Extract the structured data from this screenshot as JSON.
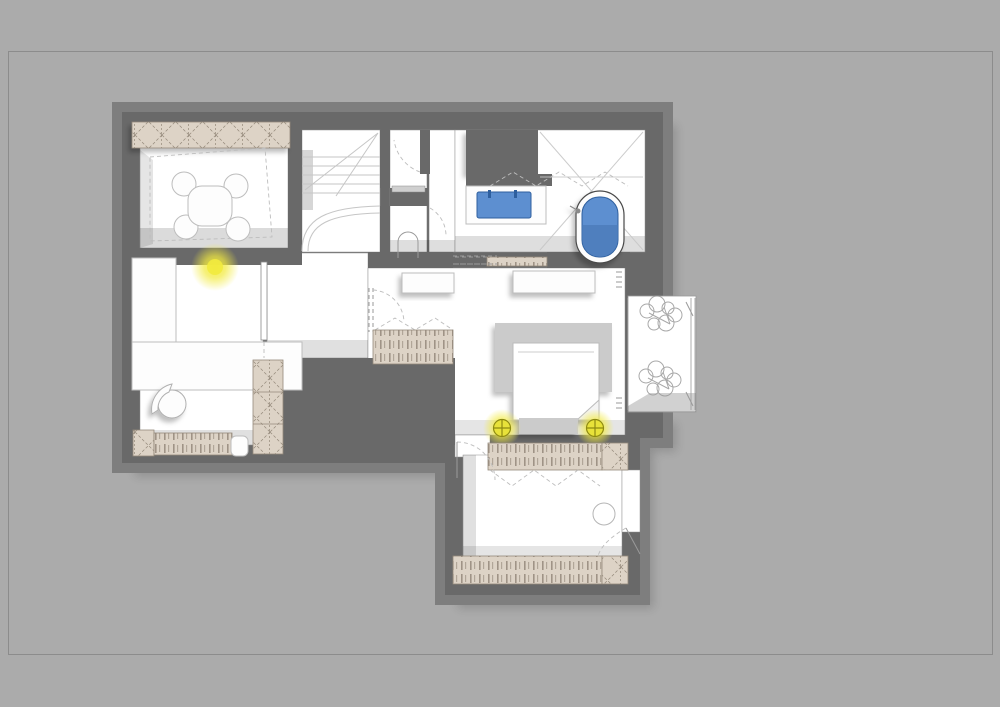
{
  "document": {
    "type": "architectural-floor-plan",
    "style": "furnished attic floor plan with extruded 3D walls on grey sheet",
    "visible_text": []
  },
  "canvas": {
    "width": 1000,
    "height": 707
  },
  "colors": {
    "page-bg": "#ababab",
    "frame-line": "#8c8c8c",
    "wall": "#696969",
    "wall-bevel": "#7e7e7e",
    "floor-white": "#ffffff",
    "line-light": "#c6c6c6",
    "line-mid": "#9a9a9a",
    "hatch-bg": "#ddd3c6",
    "hatch-line": "#94897a",
    "fixture-blue": "#5d8fd0",
    "fixture-blue-deep": "#4b7ab8",
    "fixture-blue-stroke": "#2e5f9e",
    "glow-yellow": "#f2ea3e",
    "lamp-stroke": "#8e8a12",
    "furniture-fill": "#fdfdfd",
    "furniture-gray": "#cbcbcb"
  },
  "symbols": {
    "rooms": [
      "playroom",
      "staircase",
      "wc",
      "bathroom",
      "study",
      "hallway",
      "bedroom",
      "dressing-room",
      "terrace"
    ],
    "fixtures": [
      "bathtub",
      "washbasin-blue",
      "sink-counter",
      "toilet",
      "stair-treads",
      "dining-table",
      "chair",
      "wardrobe-hatched",
      "radiator-hatched",
      "desk",
      "office-chair",
      "sofa",
      "pouf",
      "bed",
      "dresser",
      "bedside-lamp",
      "ceiling-light",
      "curtain-zigzag",
      "door-swing",
      "sliding-door",
      "threshold-strip",
      "terrace-plant",
      "terrace-railing",
      "mirror-circle",
      "dimension-ticks"
    ]
  }
}
